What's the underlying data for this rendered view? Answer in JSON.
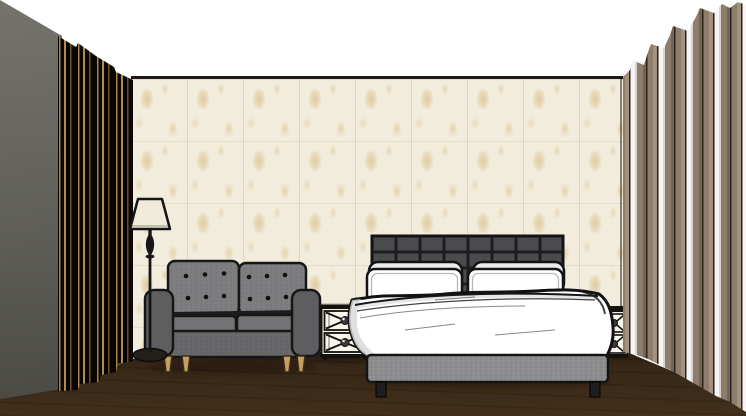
{
  "scene": {
    "type": "3d-interior-render",
    "style": "sketch-shaded bedroom elevation, one-point perspective",
    "objects": [
      {
        "name": "ceiling",
        "description": "plain white ceiling"
      },
      {
        "name": "left-wall",
        "description": "dark grey side wall receding in perspective"
      },
      {
        "name": "back-wall-wallpaper",
        "description": "cream wallpaper panels with beige damask motifs"
      },
      {
        "name": "wood-floor",
        "description": "dark walnut plank floor"
      },
      {
        "name": "left-curtain",
        "description": "floor-length black curtain with gold pinstripes"
      },
      {
        "name": "right-curtain",
        "description": "floor-length pleated curtain with taupe and white stripes"
      },
      {
        "name": "floor-lamp",
        "description": "black turned floor lamp with cream tapered shade"
      },
      {
        "name": "sofa",
        "description": "grey two-seat loveseat, button-tufted back cushions, dark arms, wooden tapered legs"
      },
      {
        "name": "bed",
        "description": "double bed with dark grey square-tufted headboard, white duvet, grey upholstered base"
      },
      {
        "name": "pillows",
        "description": "two pairs of white pillows"
      },
      {
        "name": "left-nightstand",
        "description": "white nightstand, two drawers with X lattice fronts and round knobs"
      },
      {
        "name": "right-nightstand",
        "description": "matching nightstand partly hidden behind bed and curtain"
      }
    ],
    "colors": {
      "ceiling": "#ffffff",
      "left_wall": "#74736c",
      "left_wall_dark": "#4b4a44",
      "wallpaper_base": "#f1ecdc",
      "wallpaper_motif": "#dfc79a",
      "wall_edge": "#191919",
      "floor": "#382817",
      "left_curtain_black": "#080503",
      "left_curtain_gold": "#a8824c",
      "right_curtain_taupe": "#8e7d6b",
      "right_curtain_taupe_light": "#a2927f",
      "right_curtain_white": "#f6f5f3",
      "right_curtain_dark": "#2b241c",
      "headboard": "#4b4b4e",
      "headboard_line": "#1d1d20",
      "bed_base": "#8e8e90",
      "bedding_white": "#ffffff",
      "bedding_shade": "#d7d7d7",
      "outline": "#141414",
      "sofa_cushion": "#7d7d80",
      "sofa_seat": "#737376",
      "sofa_front": "#67676a",
      "sofa_arm": "#5e5e61",
      "leg_wood": "#c79e63",
      "lamp_shade": "#f0ebd9",
      "lamp_black": "#161616",
      "nightstand_body": "#f4f0e6",
      "nightstand_trim": "#14120d"
    }
  }
}
